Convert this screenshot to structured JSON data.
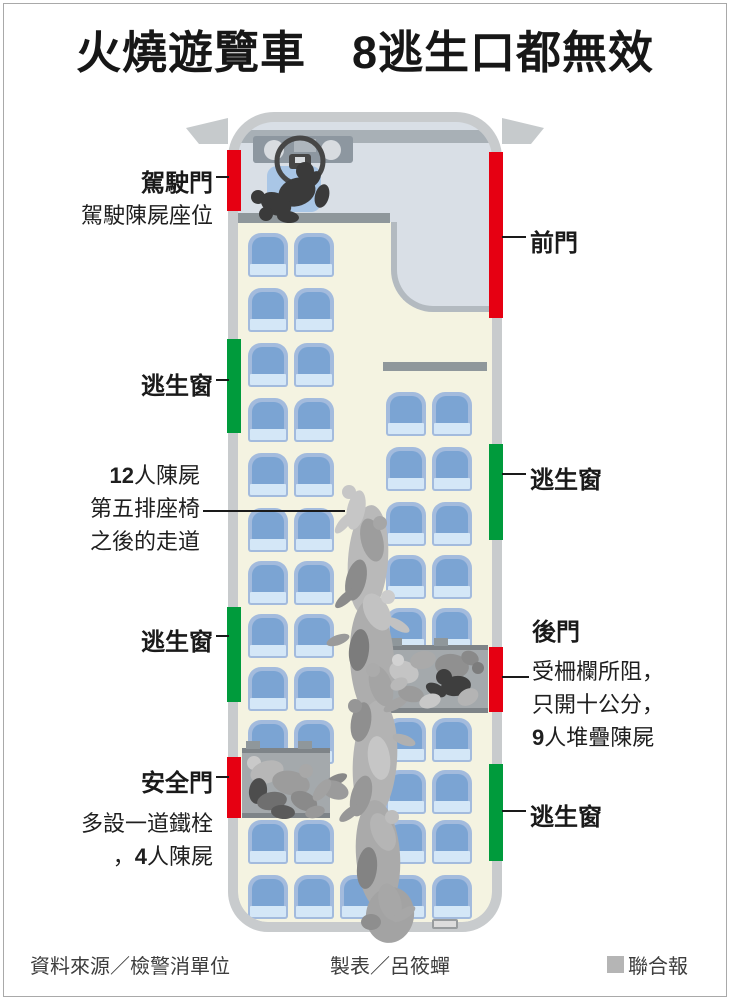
{
  "title": "火燒遊覽車　8逃生口都無效",
  "callouts": {
    "driver_door": {
      "label": "駕駛門",
      "note": "駕駛陳屍座位"
    },
    "front_door": {
      "label": "前門"
    },
    "escape_window_left_upper": {
      "label": "逃生窗"
    },
    "escape_window_left_lower": {
      "label": "逃生窗"
    },
    "escape_window_right_upper": {
      "label": "逃生窗"
    },
    "escape_window_right_lower": {
      "label": "逃生窗"
    },
    "aisle": {
      "count": "12",
      "line1": "人陳屍",
      "line2": "第五排座椅",
      "line3": "之後的走道"
    },
    "rear_door": {
      "label": "後門",
      "line1": "受柵欄所阻，",
      "line2": "只開十公分，",
      "count": "9",
      "line3": "人堆疊陳屍"
    },
    "safety_door": {
      "label": "安全門",
      "line1": "多設一道鐵栓",
      "line2_prefix": "，",
      "count": "4",
      "line2": "人陳屍"
    }
  },
  "footer": {
    "source": "資料來源／檢警消單位",
    "credit": "製表／呂筱蟬",
    "brand": "聯合報"
  },
  "colors": {
    "door_exit": "#e60012",
    "window_exit": "#009b3c",
    "brand_square": "#b5b5b5"
  }
}
